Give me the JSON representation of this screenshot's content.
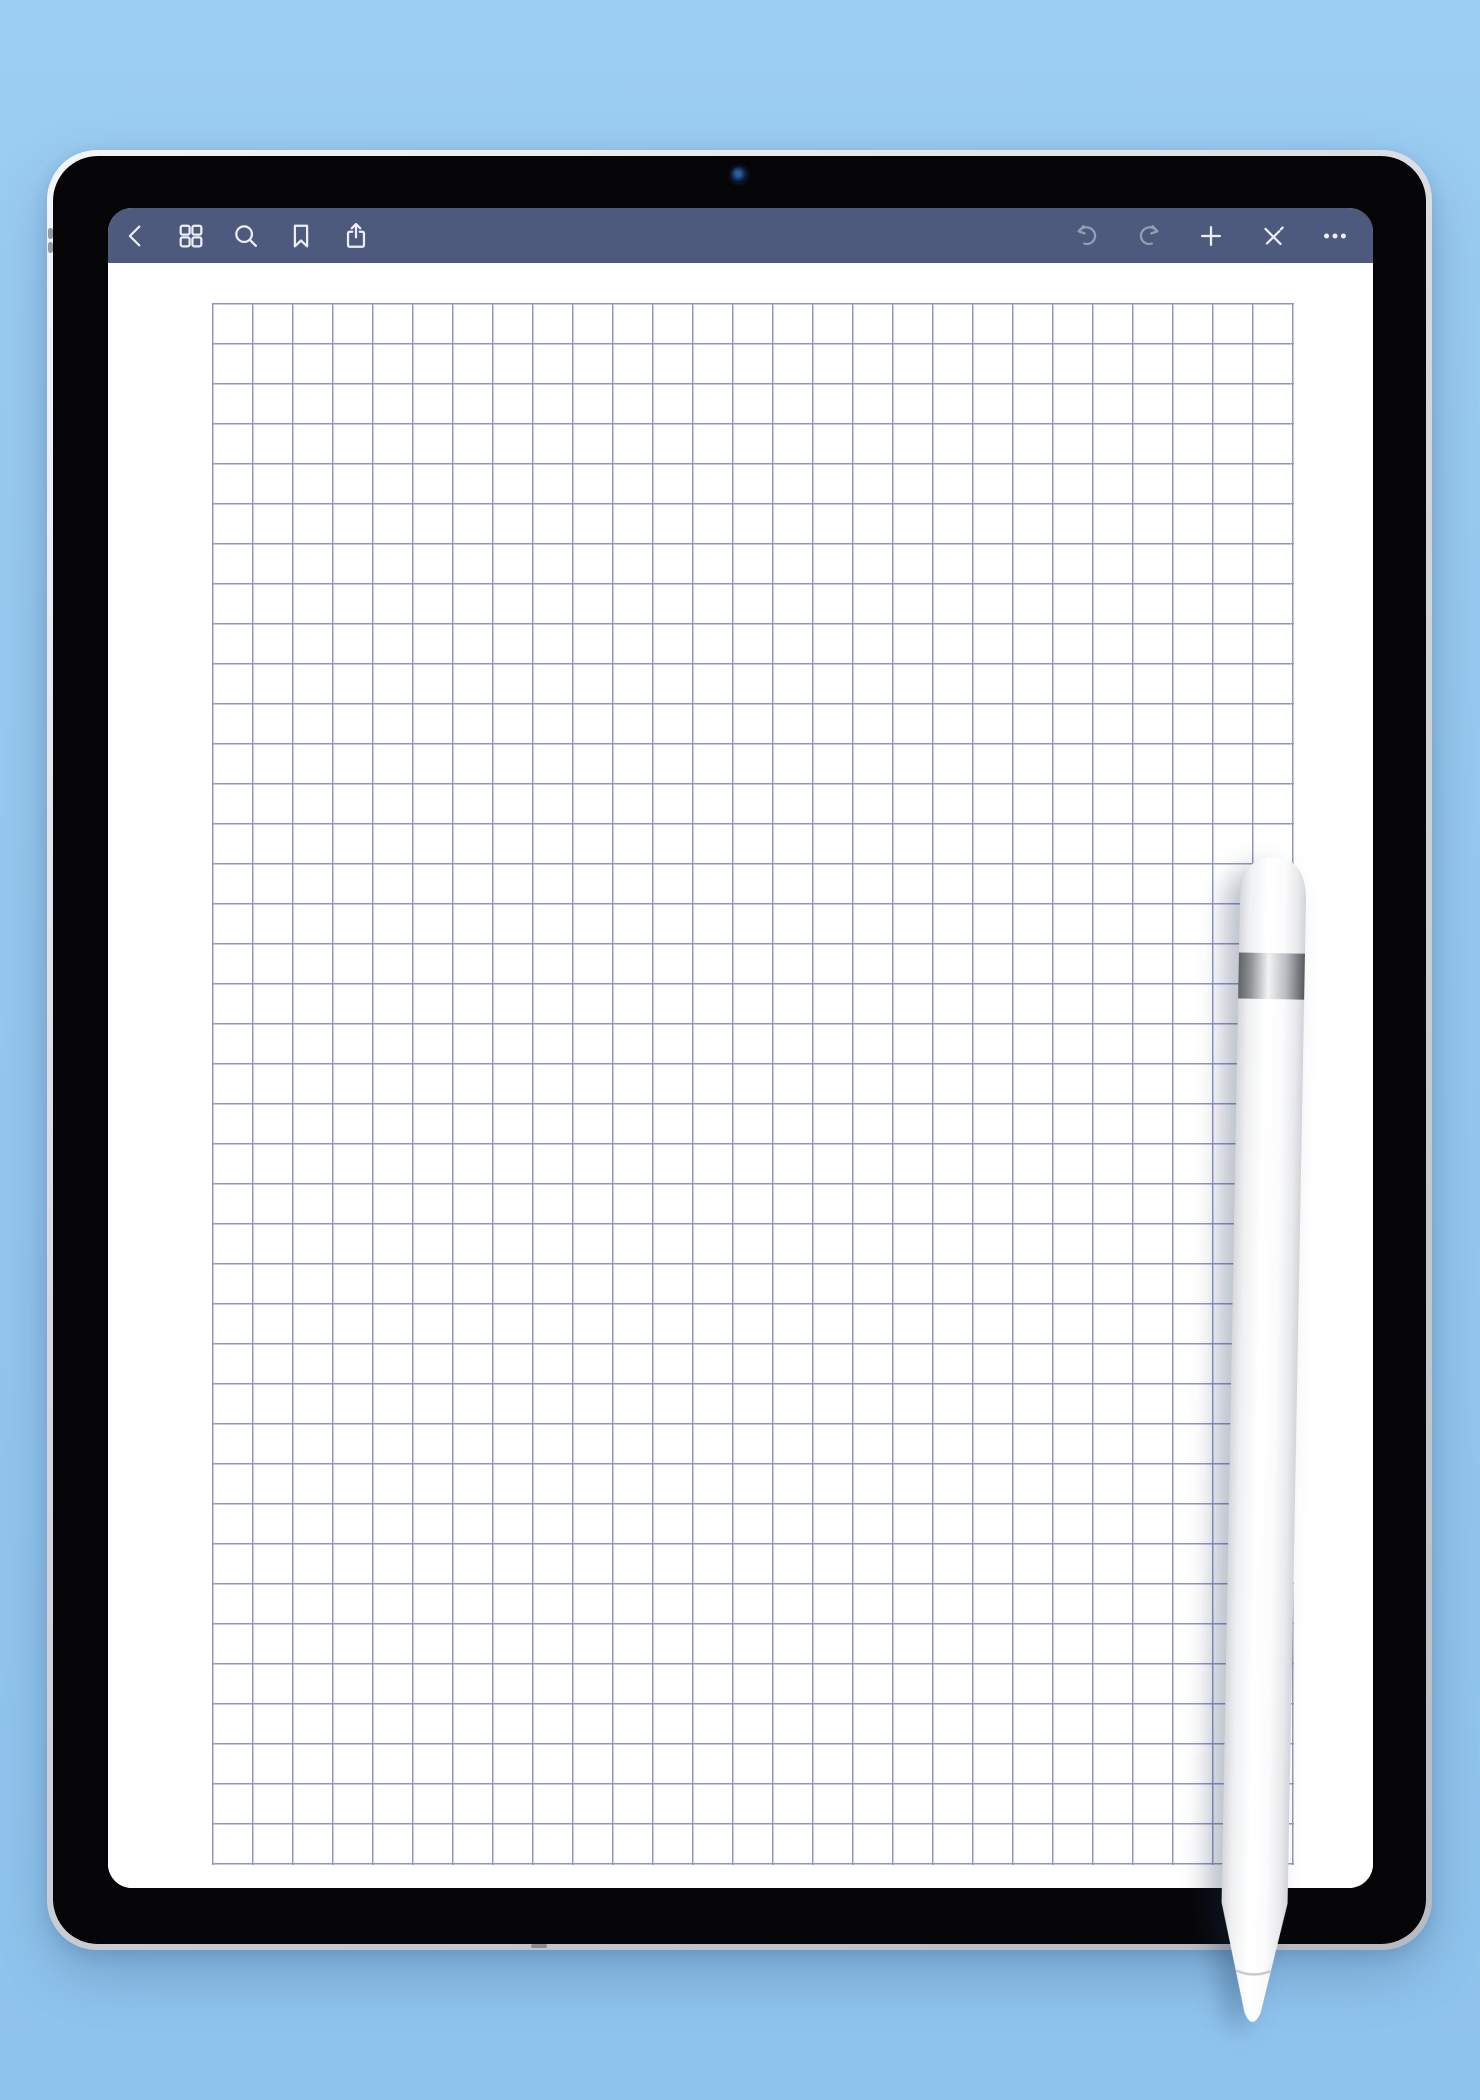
{
  "theme": {
    "background_top": "#9ccdf2",
    "background_bottom": "#8fc4ee",
    "toolbar_bg": "#4e5a7d",
    "icon_color": "#eceef4",
    "icon_dim_opacity": 0.45,
    "paper": "#ffffff",
    "grid_line": "#9195c8",
    "bezel": "#050507"
  },
  "tablet": {
    "device": "ipad-mockup",
    "camera": "front-camera",
    "side_buttons": 2
  },
  "app": {
    "toolbar": {
      "left_icons": [
        {
          "name": "back"
        },
        {
          "name": "pages-grid"
        },
        {
          "name": "search"
        },
        {
          "name": "bookmark"
        },
        {
          "name": "share"
        }
      ],
      "right_icons": [
        {
          "name": "undo",
          "disabled": true
        },
        {
          "name": "redo",
          "disabled": true
        },
        {
          "name": "add",
          "disabled": false
        },
        {
          "name": "pencil-cross",
          "disabled": false
        },
        {
          "name": "more",
          "disabled": false
        }
      ]
    },
    "page": {
      "type": "graph-paper",
      "grid": {
        "columns": 27,
        "rows": 39,
        "cell_px": 40
      }
    }
  },
  "stylus": {
    "name": "apple-pencil",
    "body_color": "#ffffff",
    "band_color": "#b9bcc1"
  }
}
